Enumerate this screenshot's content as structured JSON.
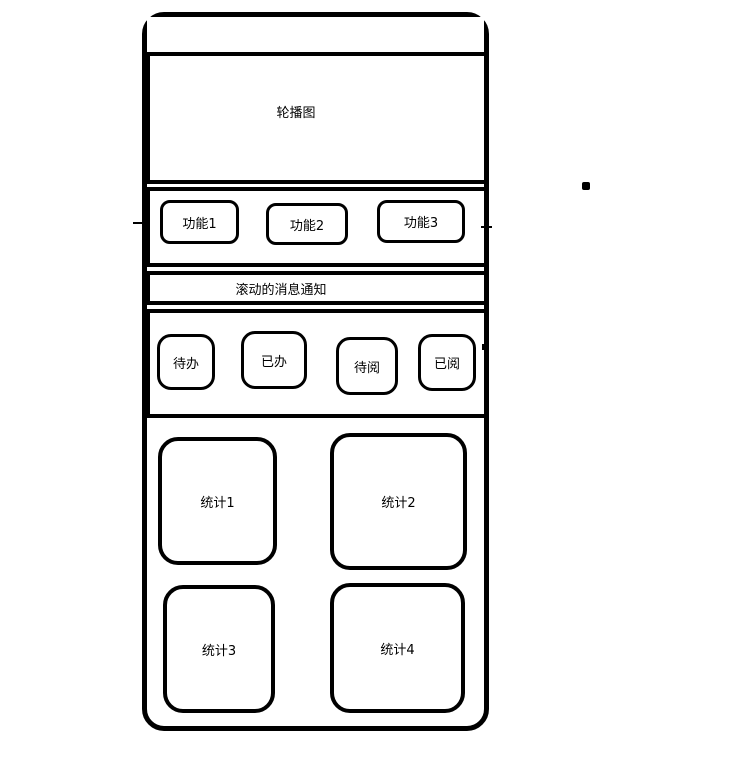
{
  "screen": {
    "carousel": {
      "label": "轮播图"
    },
    "functions": [
      {
        "label": "功能1"
      },
      {
        "label": "功能2"
      },
      {
        "label": "功能3"
      }
    ],
    "notification": {
      "label": "滚动的消息通知"
    },
    "tasks": [
      {
        "label": "待办"
      },
      {
        "label": "已办"
      },
      {
        "label": "待阅"
      },
      {
        "label": "已阅"
      }
    ],
    "stats": [
      {
        "label": "统计1"
      },
      {
        "label": "统计2"
      },
      {
        "label": "统计3"
      },
      {
        "label": "统计4"
      }
    ],
    "colors": {
      "stroke": "#000000",
      "background": "#ffffff"
    }
  }
}
